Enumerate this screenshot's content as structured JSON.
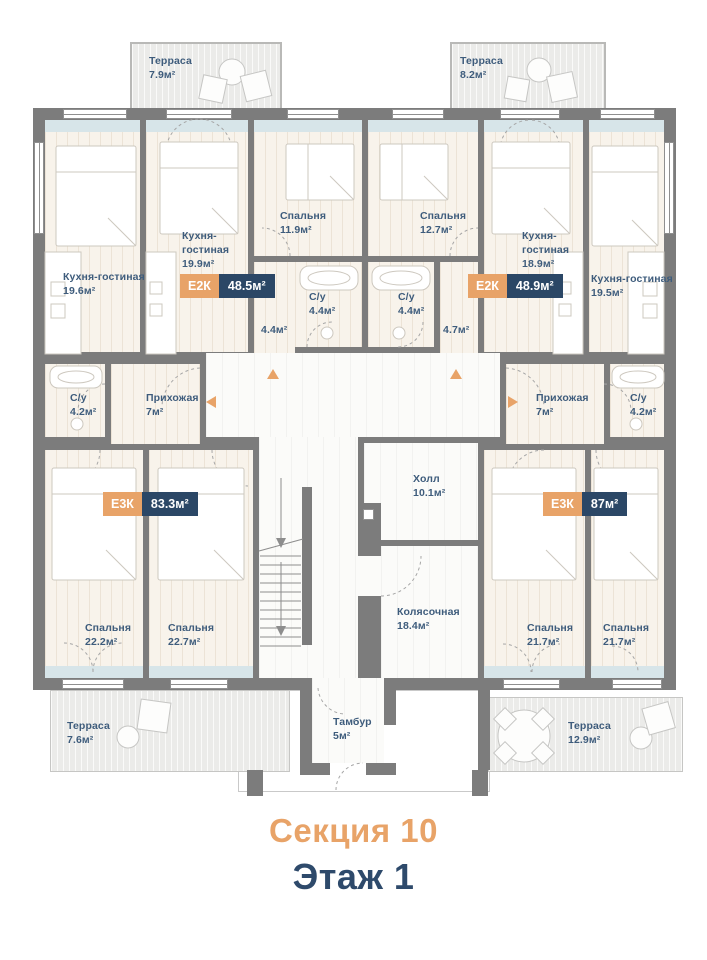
{
  "title": {
    "section": "Секция 10",
    "floor": "Этаж 1"
  },
  "palette": {
    "accent_orange": "#E8A368",
    "navy": "#2B4766",
    "label_blue": "#3E5C7C",
    "wall_gray": "#7C7C7C",
    "floor_cream": "#F8F3EB",
    "window_blue": "#D7E5E9",
    "terrace_gray": "#EBEBE9"
  },
  "terraces": [
    {
      "name": "Терраса",
      "area": "7.9м²"
    },
    {
      "name": "Терраса",
      "area": "8.2м²"
    },
    {
      "name": "Терраса",
      "area": "7.6м²"
    },
    {
      "name": "Терраса",
      "area": "12.9м²"
    }
  ],
  "badges": [
    {
      "type": "Е2К",
      "area": "48.5м²"
    },
    {
      "type": "Е2К",
      "area": "48.9м²"
    },
    {
      "type": "Е3К",
      "area": "83.3м²"
    },
    {
      "type": "Е3К",
      "area": "87м²"
    }
  ],
  "rooms": [
    {
      "name": "Кухня-гостиная",
      "area": "19.6м²"
    },
    {
      "name": "Кухня-гостиная",
      "area": "19.9м²"
    },
    {
      "name": "Спальня",
      "area": "11.9м²"
    },
    {
      "name": "Спальня",
      "area": "12.7м²"
    },
    {
      "name": "Кухня-гостиная",
      "area": "18.9м²"
    },
    {
      "name": "Кухня-гостиная",
      "area": "19.5м²"
    },
    {
      "name": "С/у",
      "area": "4.4м²"
    },
    {
      "name": "С/у",
      "area": "4.4м²"
    },
    {
      "name": "",
      "area": "4.4м²"
    },
    {
      "name": "",
      "area": "4.7м²"
    },
    {
      "name": "С/у",
      "area": "4.2м²"
    },
    {
      "name": "Прихожая",
      "area": "7м²"
    },
    {
      "name": "Прихожая",
      "area": "7м²"
    },
    {
      "name": "С/у",
      "area": "4.2м²"
    },
    {
      "name": "Холл",
      "area": "10.1м²"
    },
    {
      "name": "Колясочная",
      "area": "18.4м²"
    },
    {
      "name": "Спальня",
      "area": "22.2м²"
    },
    {
      "name": "Спальня",
      "area": "22.7м²"
    },
    {
      "name": "Спальня",
      "area": "21.7м²"
    },
    {
      "name": "Спальня",
      "area": "21.7м²"
    },
    {
      "name": "Тамбур",
      "area": "5м²"
    }
  ]
}
